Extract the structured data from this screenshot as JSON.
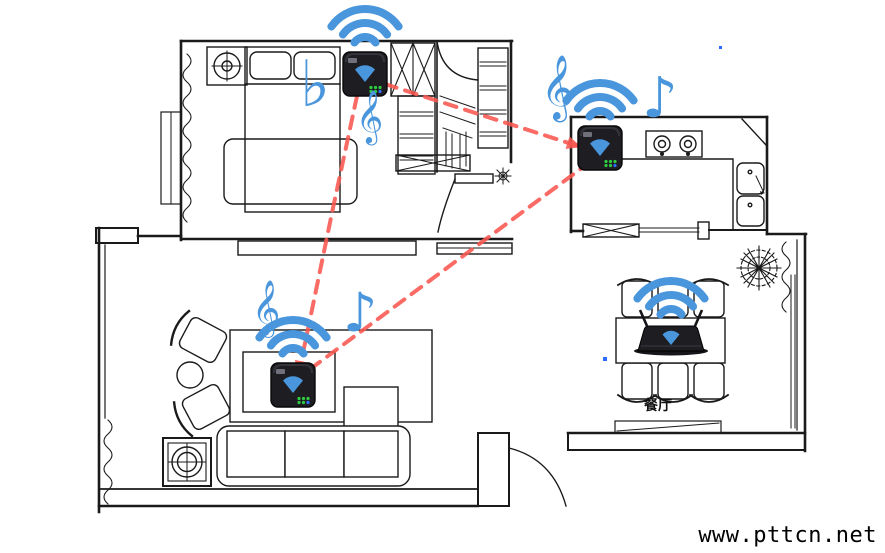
{
  "page": {
    "watermark": "www.pttcn.net",
    "background": "#ffffff"
  },
  "rooms": {
    "dining_label": "餐厅"
  },
  "colors": {
    "wall_black": "#1a1a1a",
    "wifi_blue": "#4a96dd",
    "link_red": "#f8564e",
    "device_body": "#1d1d22",
    "led_green": "#2ecc40",
    "led_blue": "#2f6fff",
    "dot_blue": "#2b6bff"
  },
  "wifi": {
    "arc_radii": [
      13,
      27,
      41
    ],
    "stroke_width": 8
  },
  "devices": [
    {
      "id": "bedroom-speaker",
      "type": "wall-box",
      "x": 365,
      "y": 74
    },
    {
      "id": "kitchen-speaker",
      "type": "wall-box",
      "x": 600,
      "y": 148
    },
    {
      "id": "living-room-speaker",
      "type": "wall-box",
      "x": 293,
      "y": 385
    },
    {
      "id": "dining-room-speaker",
      "type": "router",
      "x": 671,
      "y": 338
    }
  ],
  "connections": [
    {
      "from": "bedroom-speaker",
      "to": "living-room-speaker",
      "points": [
        [
          357,
          96
        ],
        [
          333,
          208
        ],
        [
          314,
          300
        ],
        [
          299,
          372
        ]
      ],
      "arrow": true
    },
    {
      "from": "bedroom-speaker",
      "to": "kitchen-speaker",
      "points": [
        [
          385,
          84
        ],
        [
          578,
          146
        ]
      ],
      "arrow": true
    },
    {
      "from": "kitchen-speaker",
      "to": "living-room-speaker",
      "points": [
        [
          590,
          162
        ],
        [
          309,
          370
        ]
      ],
      "arrow": false
    }
  ],
  "music_notes": [
    {
      "name": "flat-note",
      "glyph": "♭",
      "x": 300,
      "y": 106,
      "size": 64
    },
    {
      "name": "treble-clef",
      "glyph": "𝄞",
      "x": 356,
      "y": 132,
      "size": 46
    },
    {
      "name": "treble-clef",
      "glyph": "𝄞",
      "x": 541,
      "y": 106,
      "size": 56
    },
    {
      "name": "eighth-note",
      "glyph": "♪",
      "x": 642,
      "y": 117,
      "size": 56
    },
    {
      "name": "treble-clef",
      "glyph": "𝄞",
      "x": 252,
      "y": 324,
      "size": 48
    },
    {
      "name": "eighth-note",
      "glyph": "♪",
      "x": 343,
      "y": 331,
      "size": 54
    }
  ],
  "dots": [
    {
      "x": 719,
      "y": 46,
      "s": 3
    },
    {
      "x": 603,
      "y": 357,
      "s": 4
    }
  ]
}
